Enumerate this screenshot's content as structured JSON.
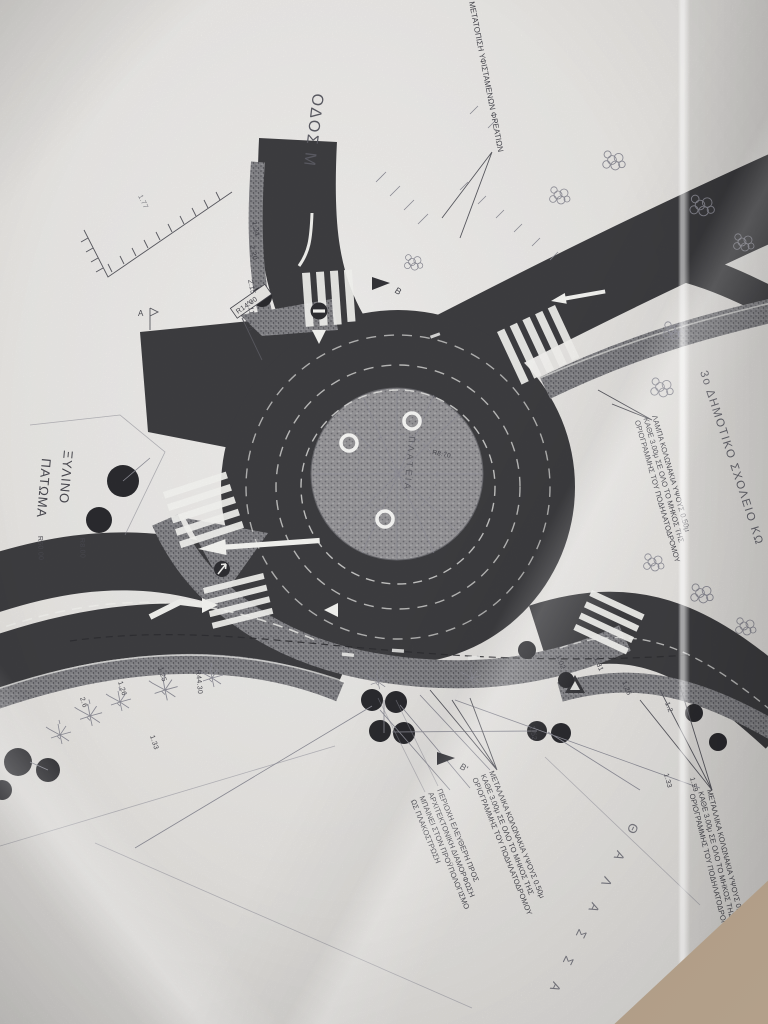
{
  "palette": {
    "asphalt": "#3f3f42",
    "paper": "#efedea",
    "table": "#b3a08a",
    "ink": "#4b4b52"
  },
  "labels": {
    "odos": "ΟΔΟΣ Μ",
    "manholes": "ΜΕΤΑΤΟΠΙΣΗ ΥΦΙΣΤΑΜΕΝΩΝ ΦΡΕΑΤΙΩΝ",
    "school": "3ο ΔΗΜΟΤΙΚΟ ΣΧΟΛΕΙΟ ΚΩ",
    "wooden1": "ΞΥΛΙΝΟ",
    "wooden2": "ΠΑΤΩΜΑ",
    "plaza": "ΠΛΑΤΕΙΑ",
    "sea": "Θ Α Λ Α Σ Σ Α",
    "lamp": [
      "ΛΑΜΠΑ ΚΟΛΩΝΑΚΙΑ ΥΨΟΥΣ 0.50μ",
      "ΚΑΘΕ 3.00μ ΣΕ ΟΛΟ ΤΟ ΜΗΚΟΣ ΤΗΣ",
      "ΟΡΙΟΓΡΑΜΜΗΣ ΤΟΥ ΠΟΔΗΛΑΤΟΔΡΟΜΟΥ"
    ],
    "metal": [
      "ΜΕΤΑΛΛΙΚΑ ΚΟΛΩΝΑΚΙΑ ΥΨΟΥΣ 0.50μ",
      "ΚΑΘΕ 3.00μ ΣΕ ΟΛΟ ΤΟ ΜΗΚΟΣ ΤΗΣ",
      "ΟΡΙΟΓΡΑΜΜΗΣ ΤΟΥ ΠΟΔΗΛΑΤΟΔΡΟΜΟΥ"
    ],
    "free": [
      "ΠΕΡΙΟΧΗ ΕΛΕΥΘΕΡΗ ΠΡΟΣ",
      "ΑΡΧΙΤΕΚΤΟΝΙΚΗ ΔΙΑΜΟΡΦΩΣΗ",
      "ΜΠΑΙΝΕΙ ΣΤΟΝ ΠΡΟΫΠΟΛΟΓΙΣΜΟ",
      "ΩΣ ΠΛΑΚΟΣΤΡΩΣΗ"
    ],
    "sections": {
      "a": "Α",
      "b": "Β",
      "b2": "Β'"
    }
  },
  "dims": {
    "r14": "R14.00",
    "r50": "R50.00",
    "r8": "R8.00",
    "r4430": "R44.30",
    "r870": "R8.70",
    "n177": "1.77",
    "n134": "1.34",
    "n220": "2.20",
    "n215": "2.15",
    "n211": "2.11",
    "n20": "2.0",
    "n26": "2.6",
    "n126a": "1.26",
    "n125": "1.25",
    "n133a": "1.33",
    "n152": "1.52",
    "n133b": "1.33",
    "n159": "1.59",
    "n102": "1.02",
    "n131": "1.31",
    "n126b": "1.26",
    "n12": "1.2"
  }
}
